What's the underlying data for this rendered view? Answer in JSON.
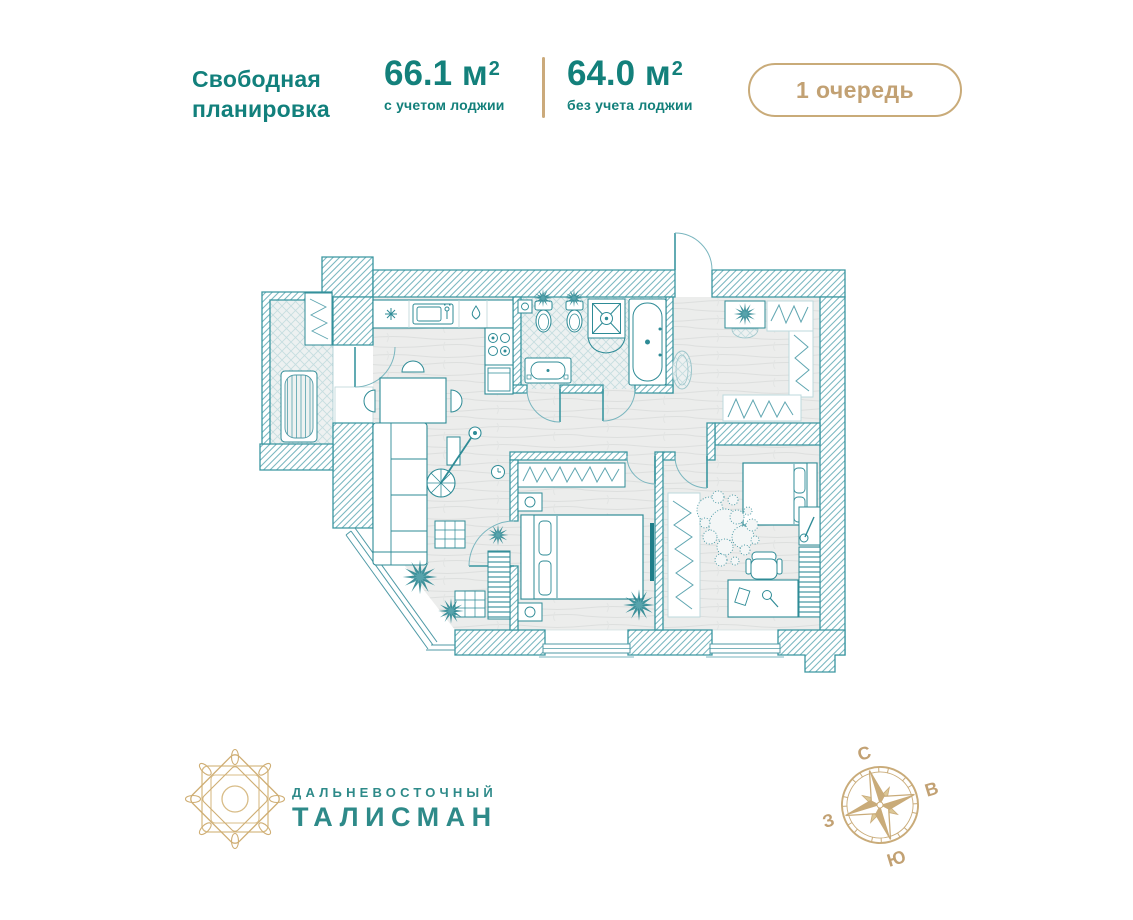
{
  "header": {
    "title": {
      "line1": "Свободная",
      "line2": "планировка"
    },
    "area_with_loggia": {
      "value": "66.1 м",
      "sup": "2",
      "label": "с учетом лоджии"
    },
    "area_without_loggia": {
      "value": "64.0 м",
      "sup": "2",
      "label": "без учета лоджии"
    },
    "phase_badge": {
      "label": "1 очередь"
    }
  },
  "floor_plan": {
    "kind": "2D architectural drawing of a free-layout apartment, no text labels"
  },
  "footer": {
    "logo": {
      "line1": "ДАЛЬНЕВОСТОЧНЫЙ",
      "line2": "ТАЛИСМАН"
    },
    "compass": {
      "n": "С",
      "e": "В",
      "s": "Ю",
      "w": "З"
    }
  },
  "colors": {
    "teal_text": "#12807c",
    "teal_plan": "#2e8b96",
    "gold": "#c2a173"
  }
}
